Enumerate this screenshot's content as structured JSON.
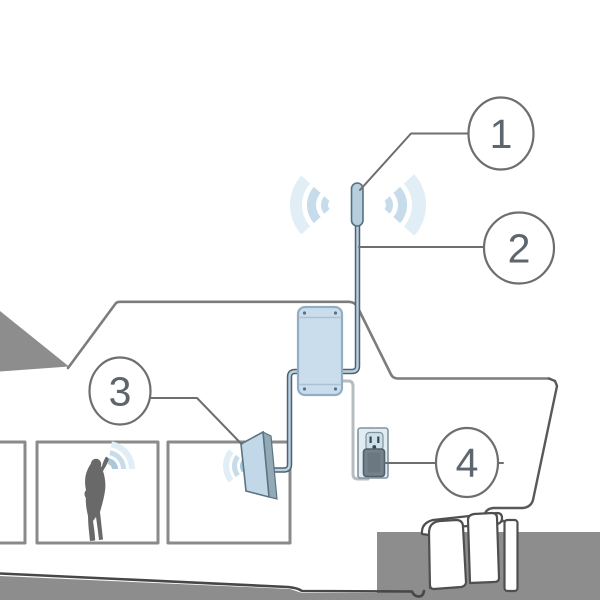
{
  "figure": {
    "kind": "installation-diagram",
    "depicts": "boat with cell signal booster system: outdoor antenna, coax cable, amplifier box, indoor panel antenna, wall outlet power supply, person using phone inside cabin"
  },
  "callouts": [
    {
      "label": "1",
      "points_to": "outdoor-antenna"
    },
    {
      "label": "2",
      "points_to": "coax-cable"
    },
    {
      "label": "3",
      "points_to": "indoor-antenna"
    },
    {
      "label": "4",
      "points_to": "power-outlet-plug"
    }
  ],
  "components": {
    "outdoor_antenna": "mast omni antenna with outgoing signal waves",
    "coax_cable": "blue coax cable from mast antenna routed behind amplifier to indoor antenna",
    "amplifier": "signal booster amplifier box with corner screws",
    "indoor_antenna": "wall-mounted indoor panel antenna with signal waves",
    "power_outlet": "duplex wall outlet with plugged-in power adapter",
    "person": "silhouette of person talking on phone with signal waves",
    "boat": "side profile of boat hull with cabin, three windows, stern and outboard motor",
    "water": "flat gray water surface"
  },
  "colors": {
    "water_gray": "#8d8d8d",
    "silhouette_gray": "#696969",
    "outline_gray": "#7c7c7c",
    "dark_outline": "#4f4f4f",
    "window_gray": "#8a8a8a",
    "callout_gray": "#6e6e6e",
    "number_gray": "#5d666c",
    "device_blue": "#cadded",
    "device_blue_medium": "#b7cede",
    "device_border_blue": "#54707f",
    "panel_front_blue": "#c2d8e8",
    "panel_side_blue": "#93a9b6",
    "cable_dark": "#4d6372",
    "cable_light": "#bcd1df",
    "power_cable_gray": "#b5bdc1",
    "outlet_fill": "#e2ebf1",
    "plug_gray": "#75828c",
    "wave_inner": "#a9c9db",
    "wave_mid": "#c6dcea",
    "wave_outer": "#e1eef5"
  }
}
